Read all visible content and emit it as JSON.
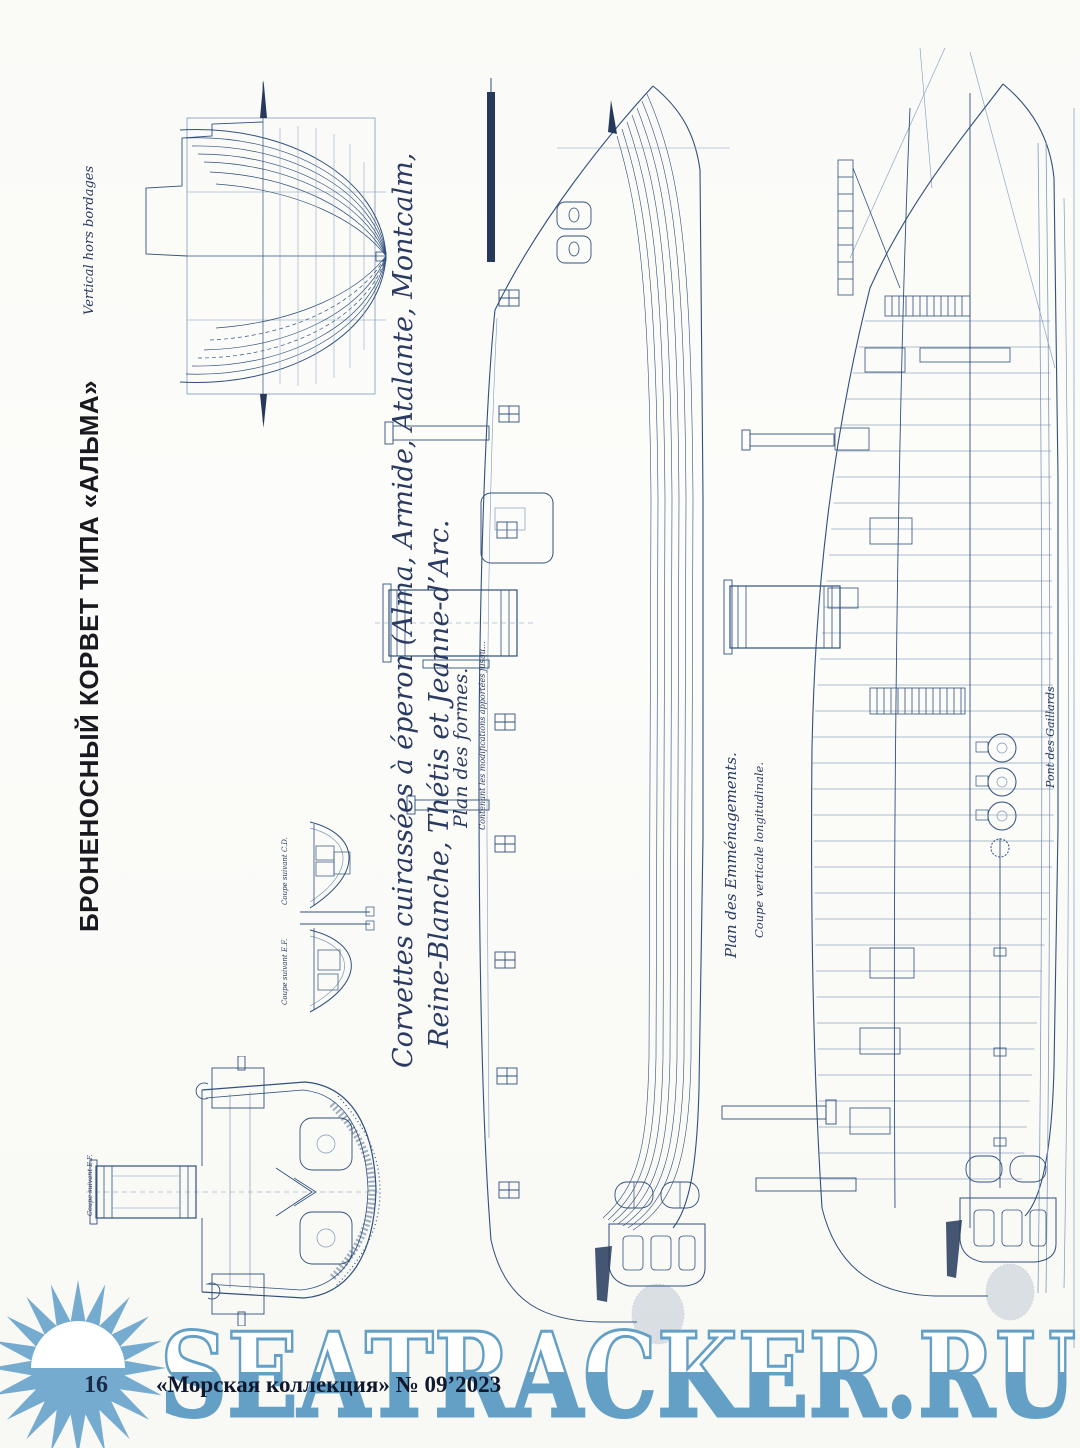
{
  "page": {
    "title_ru": "БРОНЕНОСНЫЙ КОРВЕТ ТИПА «АЛЬМА»",
    "page_number": "16",
    "magazine_credit": "«Морская коллекция» № 09’2023"
  },
  "captions": {
    "body_plan_label": "Vertical hors bordages",
    "main_line1": "Corvettes cuirassées à éperon (Alma, Armide, Atalante, Montcalm,",
    "main_line2": "Reine-Blanche, Thétis et Jeanne-d’Arc.",
    "plan_formes": "Plan des formes.",
    "plan_formes_note": "Contenant les modifications apportées jusqu…",
    "coupe_cd": "Coupe suivant C.D.",
    "coupe_ef_small": "Coupe suivant E.F.",
    "coupe_ef_large": "Coupe suivant E.F.",
    "plan_emmenagements": "Plan des Emménagements.",
    "coupe_verticale": "Coupe verticale longitudinale.",
    "pont_gaillards": "Pont des Gaillards"
  },
  "watermark": {
    "text": "SEATRACKER.RU",
    "color": "#64a0c6"
  },
  "colors": {
    "paper": "#fbfbf8",
    "ink": "#31507c",
    "ink_light": "#8099bb",
    "title": "#191920",
    "footer": "#10182e",
    "sun": "#74abce"
  }
}
